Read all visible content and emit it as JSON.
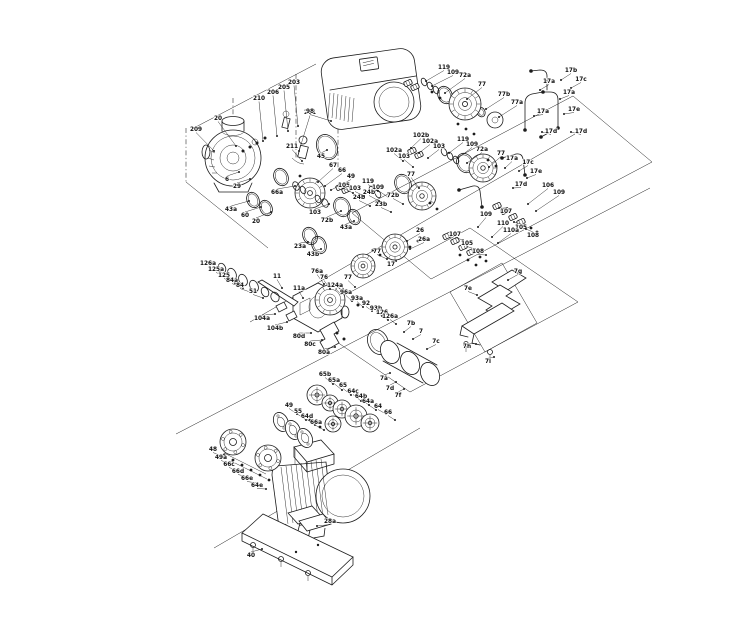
{
  "diagram": {
    "type": "exploded-parts-diagram",
    "colors": {
      "background": "#ffffff",
      "line": "#1c1c1c",
      "label": "#111111"
    },
    "callout_format": [
      "label",
      "text_x",
      "text_y",
      "leader_x",
      "leader_y"
    ],
    "callouts": [
      [
        "209",
        196,
        131,
        214,
        151
      ],
      [
        "20",
        218,
        120,
        236,
        146
      ],
      [
        "210",
        259,
        100,
        263,
        141
      ],
      [
        "206",
        273,
        94,
        277,
        136
      ],
      [
        "205",
        284,
        89,
        288,
        131
      ],
      [
        "203",
        294,
        84,
        298,
        126
      ],
      [
        "201",
        310,
        114,
        299,
        151
      ],
      [
        "211",
        292,
        148,
        302,
        161
      ],
      [
        "6",
        227,
        181,
        239,
        172
      ],
      [
        "29",
        237,
        188,
        250,
        179
      ],
      [
        "43a",
        231,
        211,
        249,
        201
      ],
      [
        "60",
        245,
        217,
        261,
        207
      ],
      [
        "20",
        256,
        223,
        271,
        212
      ],
      [
        "45",
        321,
        158,
        327,
        150
      ],
      [
        "67",
        333,
        167,
        318,
        182
      ],
      [
        "66",
        342,
        172,
        325,
        186
      ],
      [
        "49",
        351,
        178,
        331,
        190
      ],
      [
        "66a",
        277,
        194,
        295,
        186
      ],
      [
        "103",
        315,
        214,
        329,
        204
      ],
      [
        "72b",
        327,
        222,
        341,
        211
      ],
      [
        "119",
        444,
        69,
        426,
        81
      ],
      [
        "109",
        453,
        74,
        432,
        86
      ],
      [
        "72a",
        465,
        77,
        445,
        93
      ],
      [
        "77",
        482,
        86,
        467,
        99
      ],
      [
        "77b",
        504,
        96,
        486,
        109
      ],
      [
        "77a",
        517,
        104,
        499,
        117
      ],
      [
        "17b",
        571,
        72,
        561,
        80
      ],
      [
        "17c",
        581,
        81,
        571,
        88
      ],
      [
        "17a",
        549,
        83,
        540,
        90
      ],
      [
        "17a",
        569,
        94,
        560,
        99
      ],
      [
        "17e",
        574,
        111,
        564,
        114
      ],
      [
        "17d",
        581,
        133,
        571,
        132
      ],
      [
        "17a",
        543,
        113,
        534,
        116
      ],
      [
        "17d",
        551,
        133,
        542,
        132
      ],
      [
        "102b",
        421,
        137,
        411,
        148
      ],
      [
        "102a",
        430,
        143,
        419,
        153
      ],
      [
        "103",
        439,
        148,
        428,
        158
      ],
      [
        "119",
        463,
        141,
        449,
        153
      ],
      [
        "109",
        472,
        146,
        458,
        158
      ],
      [
        "72a",
        482,
        151,
        467,
        163
      ],
      [
        "77",
        501,
        155,
        489,
        167
      ],
      [
        "17a",
        512,
        160,
        505,
        168
      ],
      [
        "17c",
        528,
        164,
        519,
        171
      ],
      [
        "17e",
        536,
        173,
        527,
        178
      ],
      [
        "17d",
        521,
        186,
        513,
        188
      ],
      [
        "102a",
        394,
        152,
        403,
        161
      ],
      [
        "103",
        404,
        158,
        413,
        167
      ],
      [
        "119",
        368,
        183,
        378,
        191
      ],
      [
        "109",
        378,
        189,
        388,
        197
      ],
      [
        "72b",
        393,
        197,
        403,
        204
      ],
      [
        "24b",
        359,
        199,
        370,
        206
      ],
      [
        "23b",
        381,
        206,
        391,
        212
      ],
      [
        "77",
        411,
        176,
        419,
        188
      ],
      [
        "105",
        344,
        187,
        353,
        193
      ],
      [
        "103",
        355,
        190,
        364,
        196
      ],
      [
        "24b",
        369,
        194,
        379,
        201
      ],
      [
        "43a",
        346,
        229,
        354,
        221
      ],
      [
        "23a",
        300,
        248,
        308,
        242
      ],
      [
        "43b",
        313,
        256,
        321,
        249
      ],
      [
        "26",
        420,
        232,
        407,
        241
      ],
      [
        "26a",
        424,
        241,
        410,
        249
      ],
      [
        "77",
        377,
        253,
        387,
        259
      ],
      [
        "17",
        391,
        266,
        396,
        261
      ],
      [
        "77",
        348,
        279,
        355,
        287
      ],
      [
        "106",
        548,
        187,
        528,
        204
      ],
      [
        "109",
        559,
        194,
        536,
        211
      ],
      [
        "107",
        506,
        213,
        499,
        208
      ],
      [
        "105",
        521,
        229,
        514,
        222
      ],
      [
        "108",
        533,
        237,
        526,
        229
      ],
      [
        "109",
        486,
        216,
        478,
        227
      ],
      [
        "110",
        503,
        225,
        492,
        237
      ],
      [
        "110a",
        511,
        232,
        498,
        243
      ],
      [
        "107",
        455,
        236,
        463,
        240
      ],
      [
        "105",
        467,
        245,
        475,
        249
      ],
      [
        "108",
        478,
        253,
        486,
        255
      ],
      [
        "126a",
        208,
        265,
        219,
        271
      ],
      [
        "125a",
        216,
        271,
        227,
        277
      ],
      [
        "125",
        224,
        277,
        235,
        283
      ],
      [
        "84a",
        232,
        282,
        243,
        288
      ],
      [
        "84",
        240,
        287,
        250,
        292
      ],
      [
        "51",
        253,
        293,
        263,
        298
      ],
      [
        "11",
        277,
        278,
        282,
        288
      ],
      [
        "11a",
        299,
        290,
        303,
        298
      ],
      [
        "104a",
        262,
        320,
        275,
        314
      ],
      [
        "104b",
        275,
        330,
        287,
        322
      ],
      [
        "76a",
        317,
        273,
        324,
        284
      ],
      [
        "76",
        324,
        279,
        330,
        289
      ],
      [
        "124a",
        335,
        287,
        341,
        294
      ],
      [
        "96a",
        346,
        294,
        352,
        301
      ],
      [
        "93a",
        357,
        300,
        363,
        307
      ],
      [
        "92",
        366,
        305,
        372,
        311
      ],
      [
        "93b",
        376,
        310,
        382,
        316
      ],
      [
        "126",
        382,
        314,
        388,
        320
      ],
      [
        "126a",
        390,
        318,
        396,
        324
      ],
      [
        "80d",
        299,
        338,
        311,
        333
      ],
      [
        "80c",
        310,
        346,
        322,
        340
      ],
      [
        "80a",
        324,
        354,
        335,
        347
      ],
      [
        "7b",
        411,
        325,
        404,
        332
      ],
      [
        "7",
        421,
        333,
        413,
        339
      ],
      [
        "7c",
        436,
        343,
        427,
        349
      ],
      [
        "7a",
        384,
        380,
        390,
        373
      ],
      [
        "7d",
        390,
        390,
        396,
        382
      ],
      [
        "7f",
        398,
        397,
        404,
        389
      ],
      [
        "7g",
        518,
        273,
        508,
        280
      ],
      [
        "7e",
        468,
        290,
        477,
        295
      ],
      [
        "7h",
        467,
        348,
        476,
        344
      ],
      [
        "7i",
        488,
        363,
        494,
        357
      ],
      [
        "65b",
        325,
        376,
        333,
        384
      ],
      [
        "65a",
        334,
        382,
        342,
        390
      ],
      [
        "65",
        343,
        387,
        351,
        395
      ],
      [
        "64c",
        353,
        393,
        361,
        401
      ],
      [
        "64b",
        361,
        398,
        369,
        405
      ],
      [
        "64a",
        368,
        403,
        376,
        410
      ],
      [
        "64",
        378,
        408,
        386,
        414
      ],
      [
        "66",
        388,
        414,
        395,
        420
      ],
      [
        "49",
        289,
        407,
        297,
        414
      ],
      [
        "55",
        298,
        413,
        306,
        420
      ],
      [
        "64d",
        307,
        418,
        315,
        425
      ],
      [
        "66a",
        316,
        424,
        324,
        430
      ],
      [
        "48",
        213,
        451,
        224,
        457
      ],
      [
        "49a",
        221,
        459,
        231,
        464
      ],
      [
        "66c",
        229,
        466,
        239,
        471
      ],
      [
        "66d",
        238,
        473,
        248,
        477
      ],
      [
        "66e",
        247,
        480,
        257,
        483
      ],
      [
        "64e",
        257,
        487,
        266,
        489
      ],
      [
        "98",
        310,
        113,
        331,
        121
      ],
      [
        "28a",
        330,
        523,
        317,
        526
      ],
      [
        "40",
        251,
        557,
        262,
        549
      ]
    ]
  }
}
